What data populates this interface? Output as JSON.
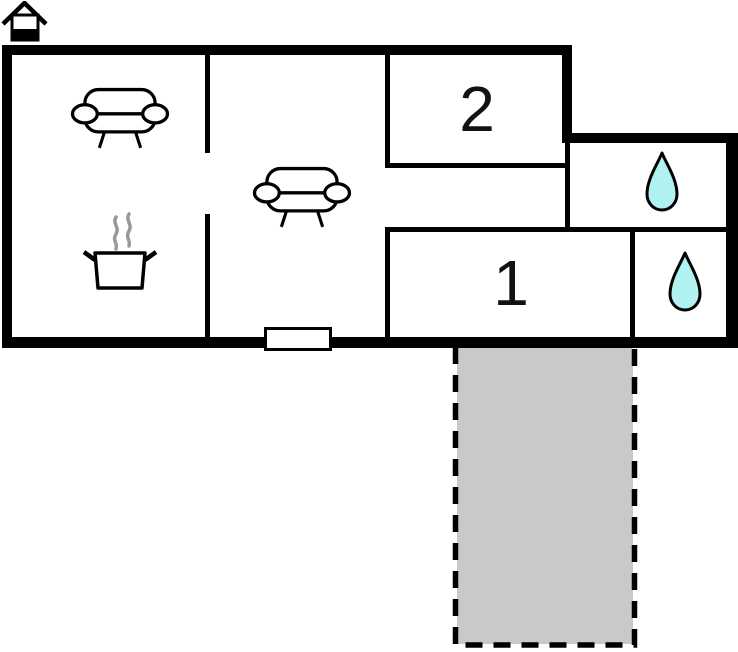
{
  "rooms": {
    "room2": {
      "label": "2"
    },
    "room1": {
      "label": "1"
    }
  },
  "icons": {
    "logo": "house-icon",
    "sofa": "sofa-icon",
    "kitchen": "cooking-pot-icon",
    "bathroom": "water-drop-icon"
  },
  "areas": {
    "terrace": {
      "name": "terrace",
      "outline": "dashed"
    }
  },
  "colors": {
    "wall": "#000000",
    "drop_fill": "#b0f1f1",
    "terrace_fill": "#c9c9c9",
    "steam": "#999999",
    "bg": "#ffffff",
    "label": "#111111"
  }
}
